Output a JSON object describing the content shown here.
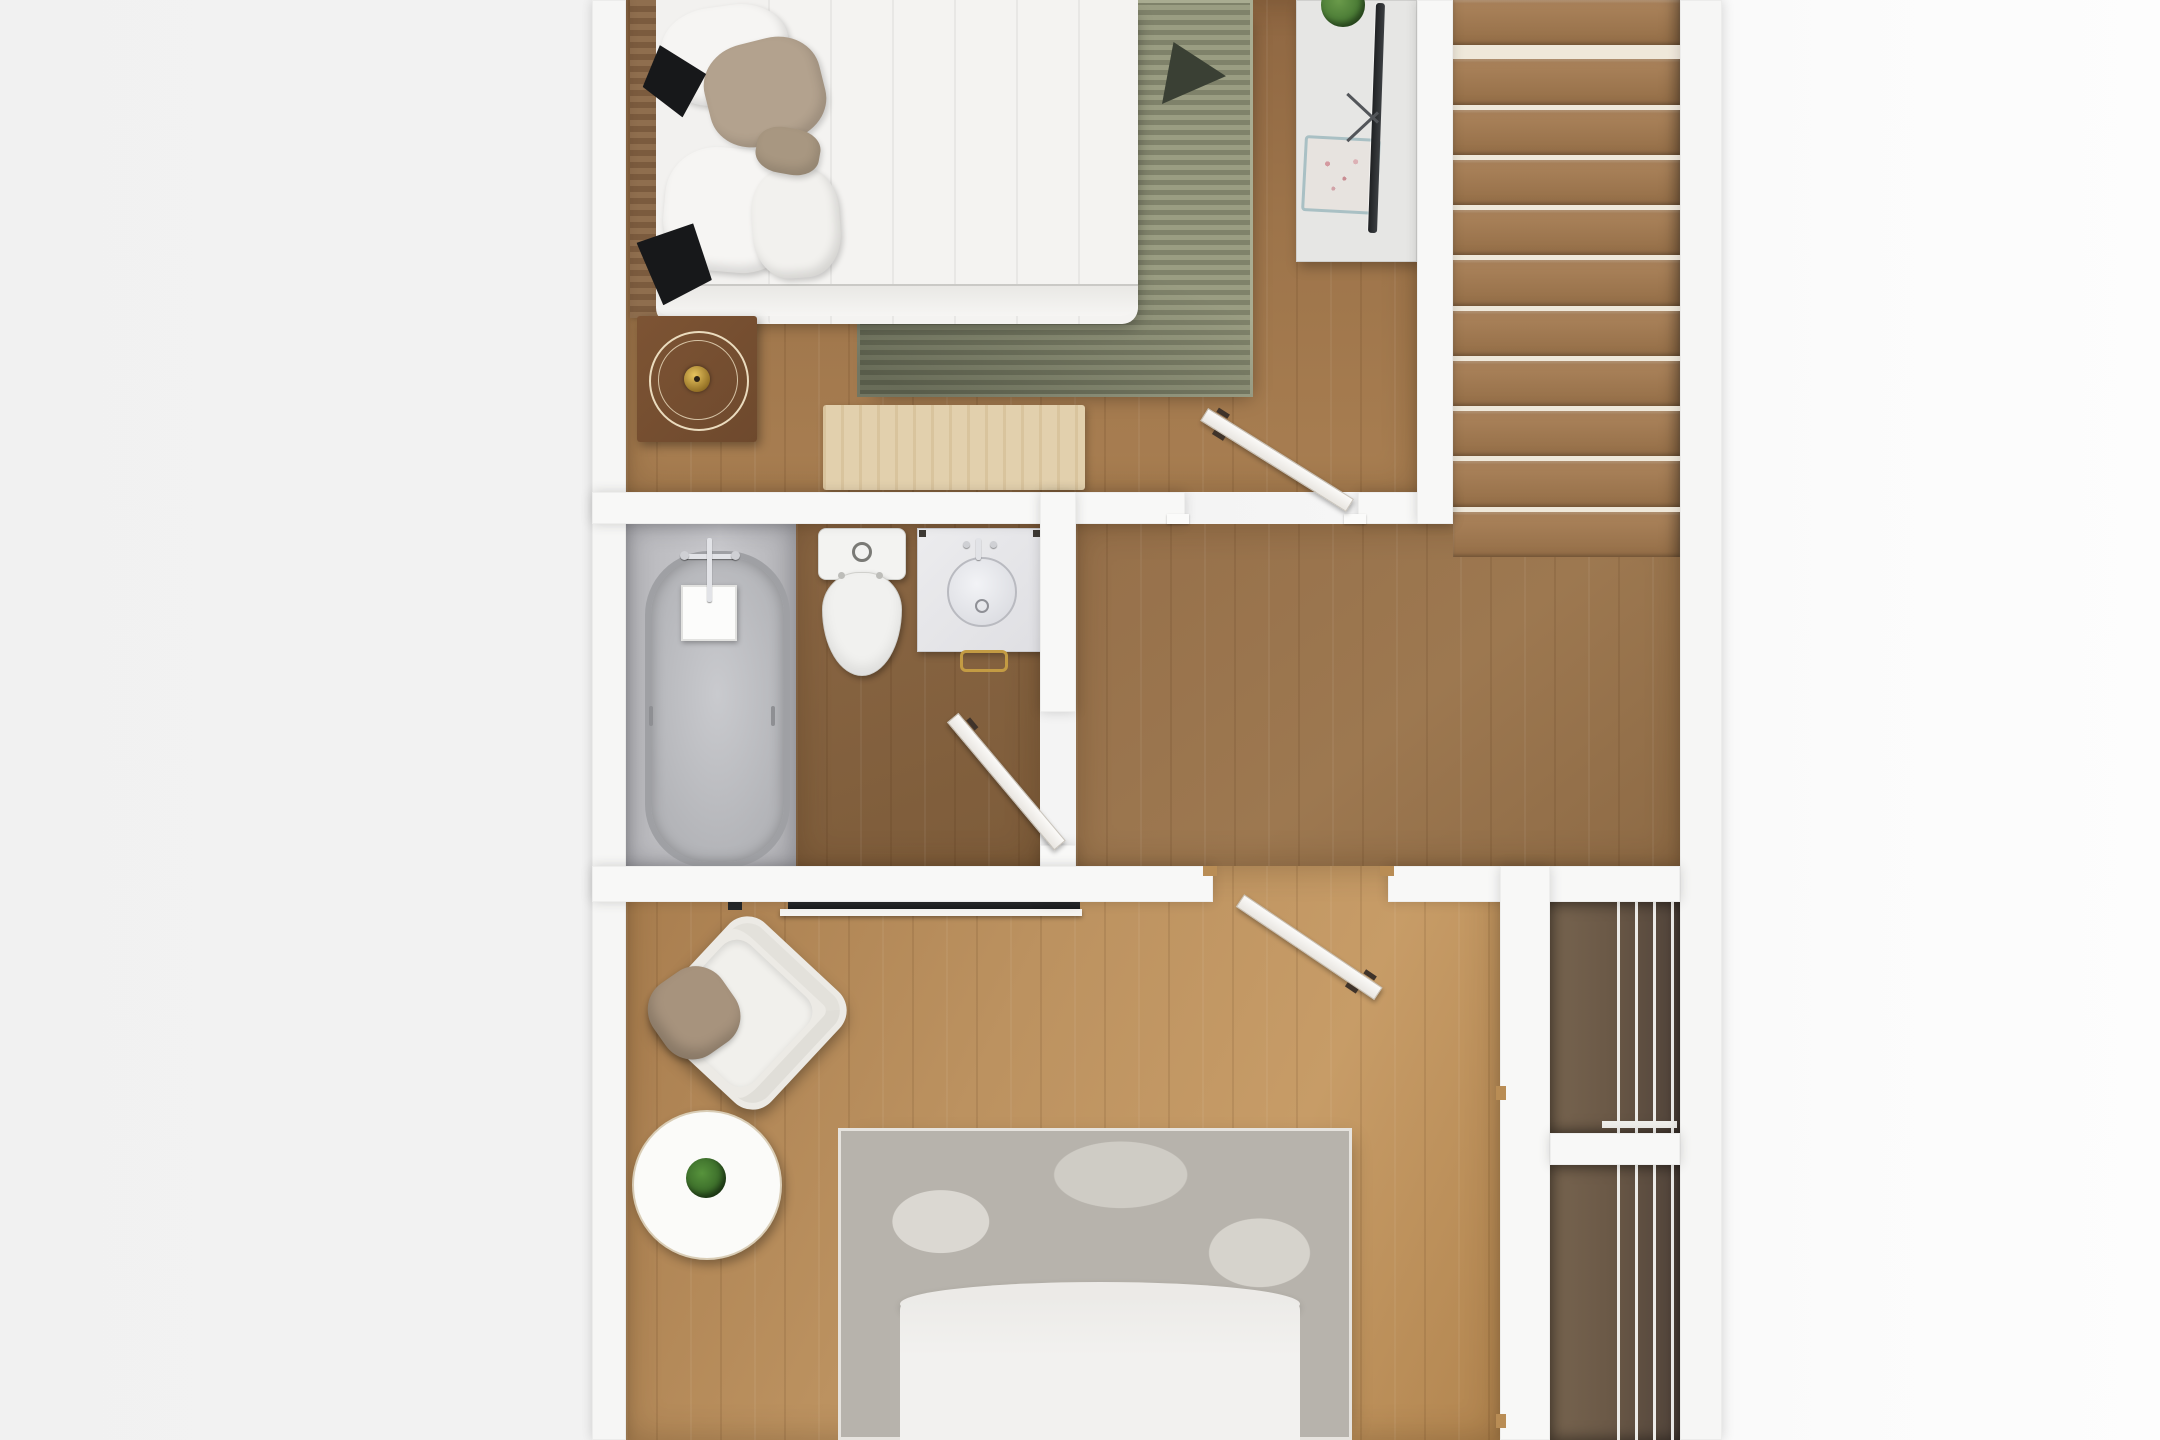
{
  "scene": {
    "description": "Top-down 3D rendered floor plan of an apartment upper floor; white walls, wooden floors, no text labels",
    "background_color": "#f3f3f3",
    "wall_color": "#f8f8f7",
    "door_color": "#f6f4f0",
    "door_count": 3
  },
  "rooms": [
    {
      "id": "bedroom-top",
      "kind": "bedroom",
      "floor_color": "#9d744a",
      "items": [
        "double-bed-white-bedding",
        "wood-slat-headboard",
        "black-garments-on-bed",
        "beige-accent-pillows",
        "white-pillows",
        "green-striped-area-rug",
        "dark-throw-on-rug",
        "round-tray-nightstand-with-gold-clock",
        "light-wood-bench",
        "media-console",
        "flat-screen-tv",
        "potted-plant",
        "decorative-food-tray"
      ]
    },
    {
      "id": "staircase",
      "kind": "stairs",
      "step_count": 11,
      "tread_color": "#a37b52",
      "gap_color": "#efe8da"
    },
    {
      "id": "bathroom",
      "kind": "bathroom",
      "floor_color": "#8a6643",
      "tub_platform_color": "#c2c2c6",
      "items": [
        "bathtub",
        "bath-faucet",
        "shower-tray",
        "toilet",
        "vanity-sink",
        "gold-towel-ring"
      ]
    },
    {
      "id": "landing",
      "kind": "hallway",
      "floor_color": "#997349",
      "items": []
    },
    {
      "id": "bedroom-bottom",
      "kind": "bedroom",
      "floor_color": "#bc9260",
      "items": [
        "wall-mounted-tv",
        "media-shelf",
        "wall-speaker",
        "accent-armchair",
        "taupe-throw-pillow",
        "round-side-table",
        "potted-plant",
        "gray-distressed-rug",
        "double-bed-white-bedding"
      ]
    },
    {
      "id": "closet",
      "kind": "closet",
      "sections": 2,
      "shelf_color": "#6b5947",
      "slat_color": "#ecebe8"
    }
  ],
  "rugs": {
    "striped_rug": {
      "base": "#9a9d82",
      "stripe": "#7f826a"
    },
    "gray_rug": {
      "base": "#b7b3ac",
      "patch": "#d9d6cf"
    },
    "bench_mat": {
      "color": "#e2d0ad"
    }
  },
  "doors": [
    "bedroom-top-to-landing",
    "bathroom-to-landing",
    "landing-to-bedroom-bottom"
  ]
}
